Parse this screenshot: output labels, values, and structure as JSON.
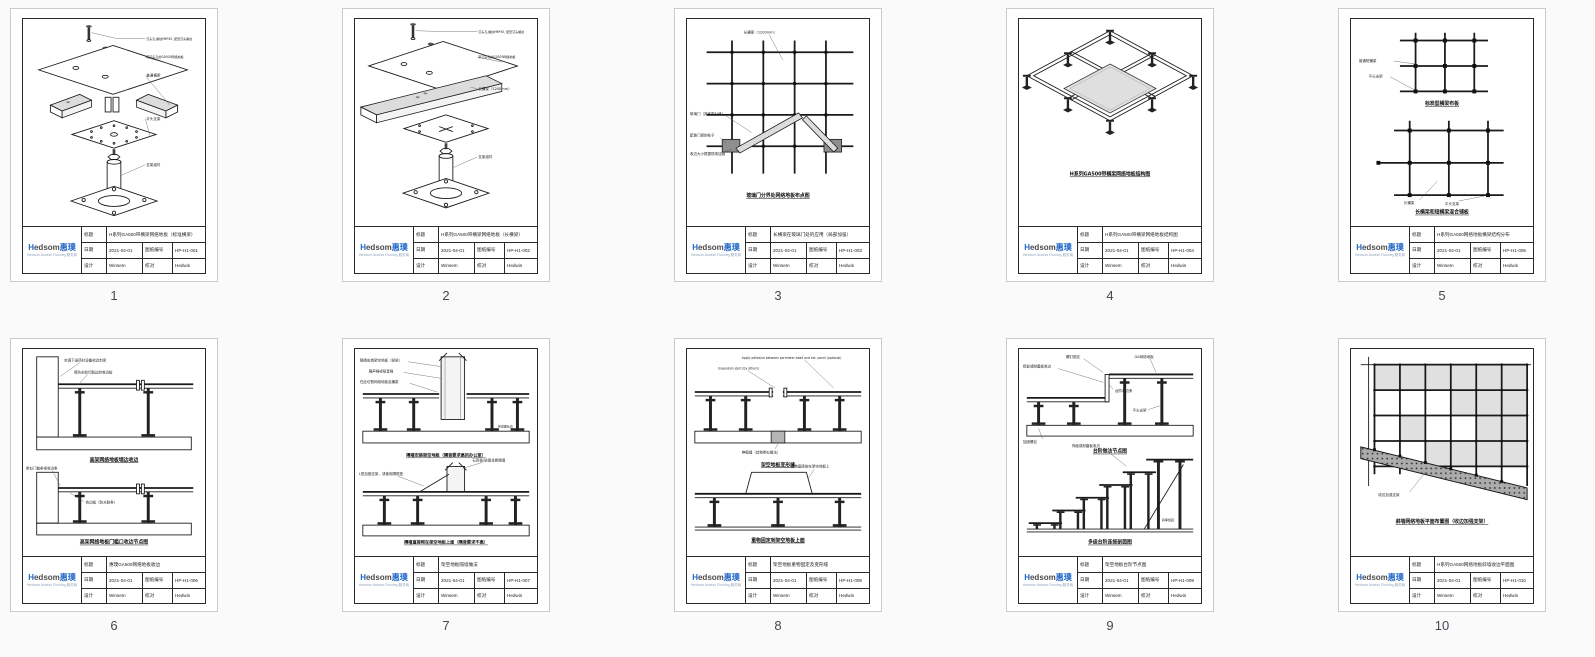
{
  "titleblock": {
    "labels": {
      "title": "标题",
      "date": "日期",
      "number": "图纸编号",
      "design": "设计",
      "check": "校对"
    },
    "logo": {
      "brand_h": "H",
      "brand_rest": "edsom",
      "brand_cn": "惠璞",
      "tagline": "Hedsom Access Flooring 服务商"
    }
  },
  "sheets": [
    {
      "page": "1",
      "title": "H系列GA500带横梁网络地板（标准横梁）",
      "date": "2021-04-01",
      "number": "HP-H1-001",
      "designer": "Winsem",
      "checker": "Hedwin",
      "captions": [],
      "annotations": [
        "沉头孔,螺纹M6*45, 配套沉头螺丝",
        "带沉头孔的GA500网络地板",
        "普通横梁",
        "平头支架",
        "支架组件"
      ]
    },
    {
      "page": "2",
      "title": "H系列GA500带横梁网络地板（长横梁）",
      "date": "2021-04-01",
      "number": "HP-H1-002",
      "designer": "Winsem",
      "checker": "Hedwin",
      "captions": [],
      "annotations": [
        "沉头孔,螺纹M6*45, 配套沉头螺丝",
        "带沉头孔的GA500网络地板",
        "长横梁（1200mm）",
        "支架组件"
      ]
    },
    {
      "page": "3",
      "title": "长横梁在玻璃门处的应用（局部加强）",
      "date": "2021-04-01",
      "number": "HP-H1-003",
      "designer": "Winsem",
      "checker": "Hedwin",
      "captions": [
        "玻璃门分界处网络地板布点图"
      ],
      "annotations": [
        "长横梁（1200mm）",
        "玻璃门（其他类似墙）",
        "配玻门梁的柱子",
        "收边大小根据现场加固"
      ]
    },
    {
      "page": "4",
      "title": "H系列GA500带横梁网络地板结构图",
      "date": "2021-04-01",
      "number": "HP-H1-004",
      "designer": "Winsem",
      "checker": "Hedwin",
      "captions": [
        "H系列GA500带横梁网络地板结构图"
      ],
      "annotations": []
    },
    {
      "page": "5",
      "title": "H系列GA500网络地板横梁结构分布",
      "date": "2021-04-01",
      "number": "HP-H1-005",
      "designer": "Winsem",
      "checker": "Hedwin",
      "captions": [
        "标准型横梁布板",
        "长横梁和短横梁混合铺板"
      ],
      "annotations": [
        "普通短横梁",
        "平头支架",
        "长横梁",
        "平头支架"
      ]
    },
    {
      "page": "6",
      "title": "惠璞GA500网络地板收边",
      "date": "2021-04-01",
      "number": "HP-H1-006",
      "designer": "Winsem",
      "checker": "Hedwin",
      "captions": [
        "高架网络地板墙边收边",
        "高架网络地板门槛口收边节点图"
      ],
      "annotations": [
        "空调下送风时设备收边封闭",
        "用防水胶切割过的收边板",
        "类似门槛条或收边条",
        "收边板（防水胶条）"
      ]
    },
    {
      "page": "7",
      "title": "架空地板隔墙做法",
      "date": "2021-04-01",
      "number": "HP-H1-007",
      "designer": "Winsem",
      "checker": "Hedwin",
      "captions": [
        "隔墙安装架空地板（隔音要求高的办公室）",
        "隔墙直接砌在架空地板上面（隔音要求不高）"
      ],
      "annotations": [
        "隔墙安装架空地板（轻质）",
        "隔声棉或吸音棉",
        "在此切割网络地板及横梁",
        "完成面标高",
        "L型加固支架，或使用隔振垫",
        "石膏板/轻钢龙骨隔墙"
      ]
    },
    {
      "page": "8",
      "title": "架空地板重物固定及变形缝",
      "date": "2021-04-01",
      "number": "HP-H1-008",
      "designer": "Winsem",
      "checker": "Hedwin",
      "captions": [
        "架空地板变形缝",
        "重物固定到架空地板上面"
      ],
      "annotations": [
        "Expansion joint (by others)",
        "Apply adhesive between perimeter bead and ext. panel (optional)",
        "伸缩缝（其他类似做法）",
        "重物直接放在架空地板上"
      ]
    },
    {
      "page": "9",
      "title": "架空地板台阶节点图",
      "date": "2021-04-01",
      "number": "HP-H1-009",
      "designer": "Winsem",
      "checker": "Hedwin",
      "captions": [
        "台阶做法节点图",
        "多级台阶连接剖面图"
      ],
      "annotations": [
        "螺钉固定",
        "GA网络地板",
        "铝板或耐磨板收边",
        "台阶收边条",
        "平头支架",
        "加固螺丝",
        "饰面或耐磨板收边",
        "斜撑加固"
      ]
    },
    {
      "page": "10",
      "title": "H系列GA500网络地板斜墙收边平面图",
      "date": "2021-04-01",
      "number": "HP-H1-010",
      "designer": "Winsem",
      "checker": "Hedwin",
      "captions": [
        "斜墙网络地板平面布置图（收边加强支架）"
      ],
      "annotations": [
        "收边加强支架"
      ]
    }
  ]
}
